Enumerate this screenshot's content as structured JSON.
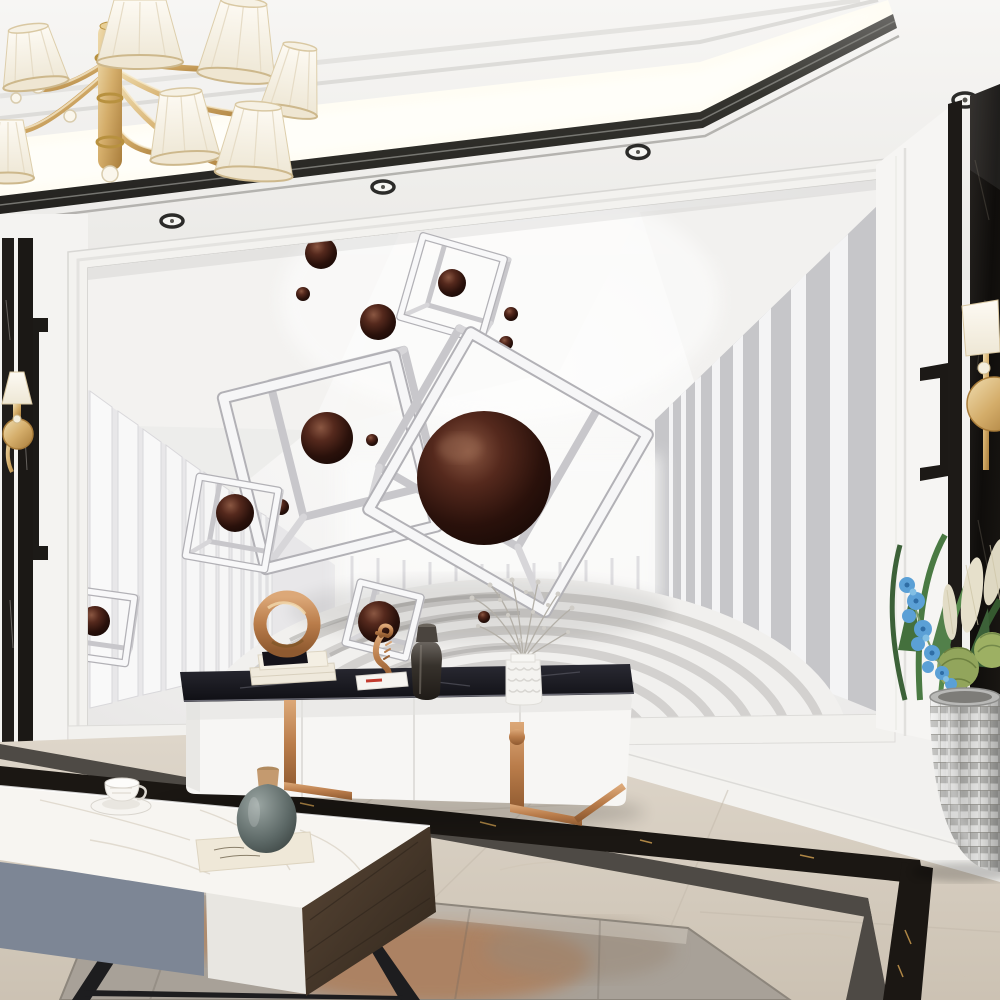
{
  "scene": {
    "kind": "photograph",
    "subject": "modern-living-room-with-3d-geometric-mural-wall",
    "elements": [
      "gold-chandelier-with-white-shades",
      "recessed-ceiling-cove-with-dark-metal-trim",
      "ceiling-spotlights",
      "mural-wall-white-tunnel-with-wireframe-cubes-and-dark-spheres",
      "zen-concentric-ring-floor-in-mural",
      "black-marble-wall-panels-with-gold-sconces",
      "white-tv-cabinet-with-black-marble-top-and-copper-legs",
      "decor-copper-ring-sculpture-books-seahorse-vases",
      "white-marble-coffee-table-with-teacup-book-and-vase",
      "silver-mosaic-planter-with-blue-orchids-and-greenery",
      "beige-marble-floor-with-black-border-inlay",
      "gray-rust-area-rug"
    ]
  },
  "palette": {
    "wall_white": "#f5f4f2",
    "ceiling_trim_dark": "#3b3a38",
    "cove_light": "#fffdf4",
    "mural_column_gray": "#c6c6c9",
    "sphere_brown_dark": "#24100a",
    "sphere_brown_high": "#8a5742",
    "gold": "#d4ad6a",
    "copper": "#b97c4a",
    "black_marble": "#15131a",
    "gold_vein": "#c99a4e",
    "floor_beige": "#d5ccbf",
    "border_gray": "#4e4a45",
    "rug_base": "#a8a198",
    "rug_rust": "#b06a38",
    "table_drawer_blue": "#7d8695",
    "wood_dark": "#4a3a2b",
    "leaf_green": "#4a7a43",
    "orchid_blue": "#5ba0d6",
    "silver": "#c9c9c8"
  },
  "counts": {
    "chandelier_shades_visible": 7,
    "mural_wireframe_cubes": 5,
    "mural_spheres_large": 1,
    "ceiling_spotlights_visible": 4
  }
}
